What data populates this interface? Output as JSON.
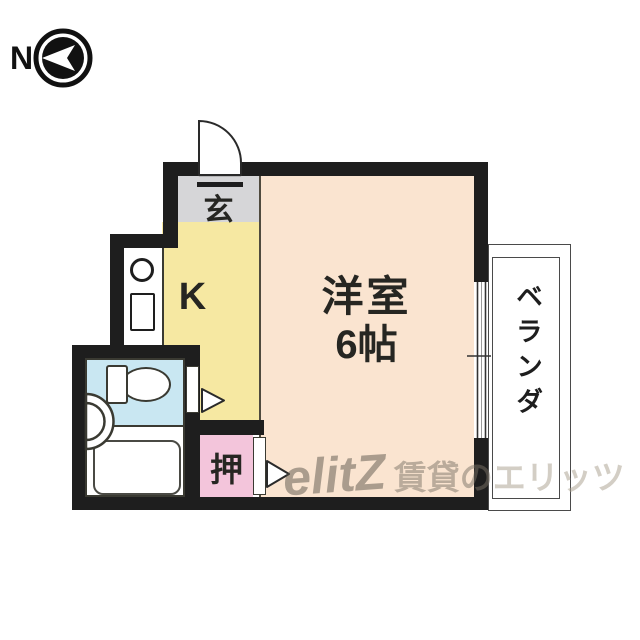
{
  "compass": {
    "label": "N"
  },
  "rooms": {
    "genkan": {
      "label": "玄"
    },
    "kitchen": {
      "label": "K"
    },
    "main_room": {
      "label_line1": "洋室",
      "label_line2": "6帖"
    },
    "closet": {
      "label": "押"
    },
    "veranda": {
      "label": "ベランダ"
    }
  },
  "watermark": {
    "logo": "elitZ",
    "text_dark": "賃貸の",
    "text_light": "エリッツ"
  },
  "colors": {
    "wall": "#1e1e1e",
    "main_room_fill": "#fae4d0",
    "kitchen_fill": "#f6e8a2",
    "genkan_fill": "#d6d6d8",
    "bathroom_fill": "#c9e7f2",
    "closet_fill": "#f3c5db",
    "watermark_gray": "#8d857a"
  }
}
